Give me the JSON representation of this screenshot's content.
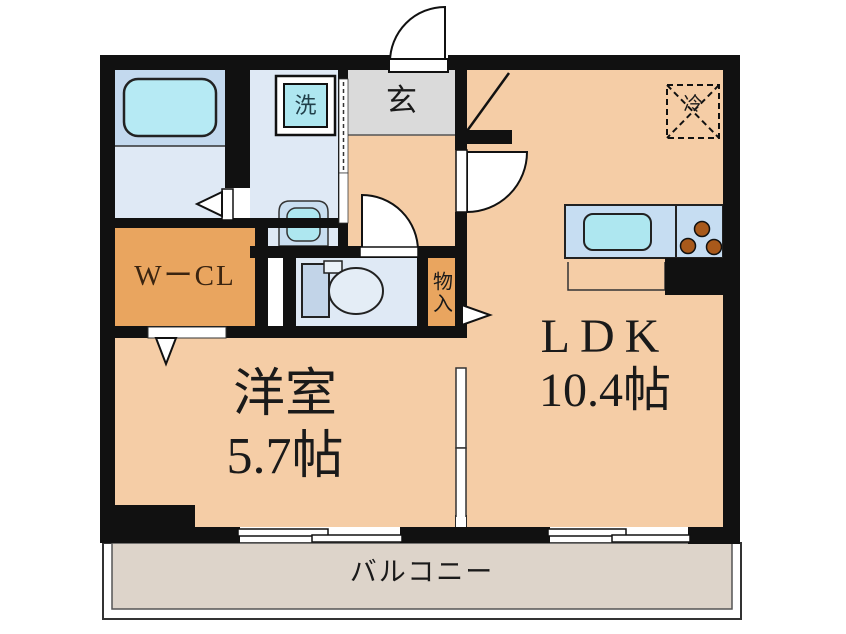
{
  "rooms": {
    "entrance": {
      "label": "玄"
    },
    "laundry": {
      "label": "洗"
    },
    "walk_in_closet": {
      "label": "WーCL"
    },
    "storage": {
      "label": "物入"
    },
    "western_room": {
      "label": "洋室",
      "area": "5.7帖"
    },
    "ldk": {
      "label": "LDK",
      "area": "10.4帖"
    },
    "refrigerator": {
      "label": "冷"
    },
    "balcony": {
      "label": "バルコニー"
    }
  },
  "colors": {
    "floor_main": "#F5CDA6",
    "closet_floor": "#E9A55F",
    "wet_area_floor": "#DFE9F5",
    "bathroom_floor": "#C3D9EE",
    "entrance_floor": "#DADADA",
    "balcony_floor": "#DDD4CA",
    "fixture_cyan": "#AEE7F0",
    "tub_cyan": "#B6EAF4",
    "counter_blue": "#C6DDF2",
    "toilet_tank": "#C2D4E8",
    "burner_brown": "#A8591B",
    "wall": "#111111"
  }
}
